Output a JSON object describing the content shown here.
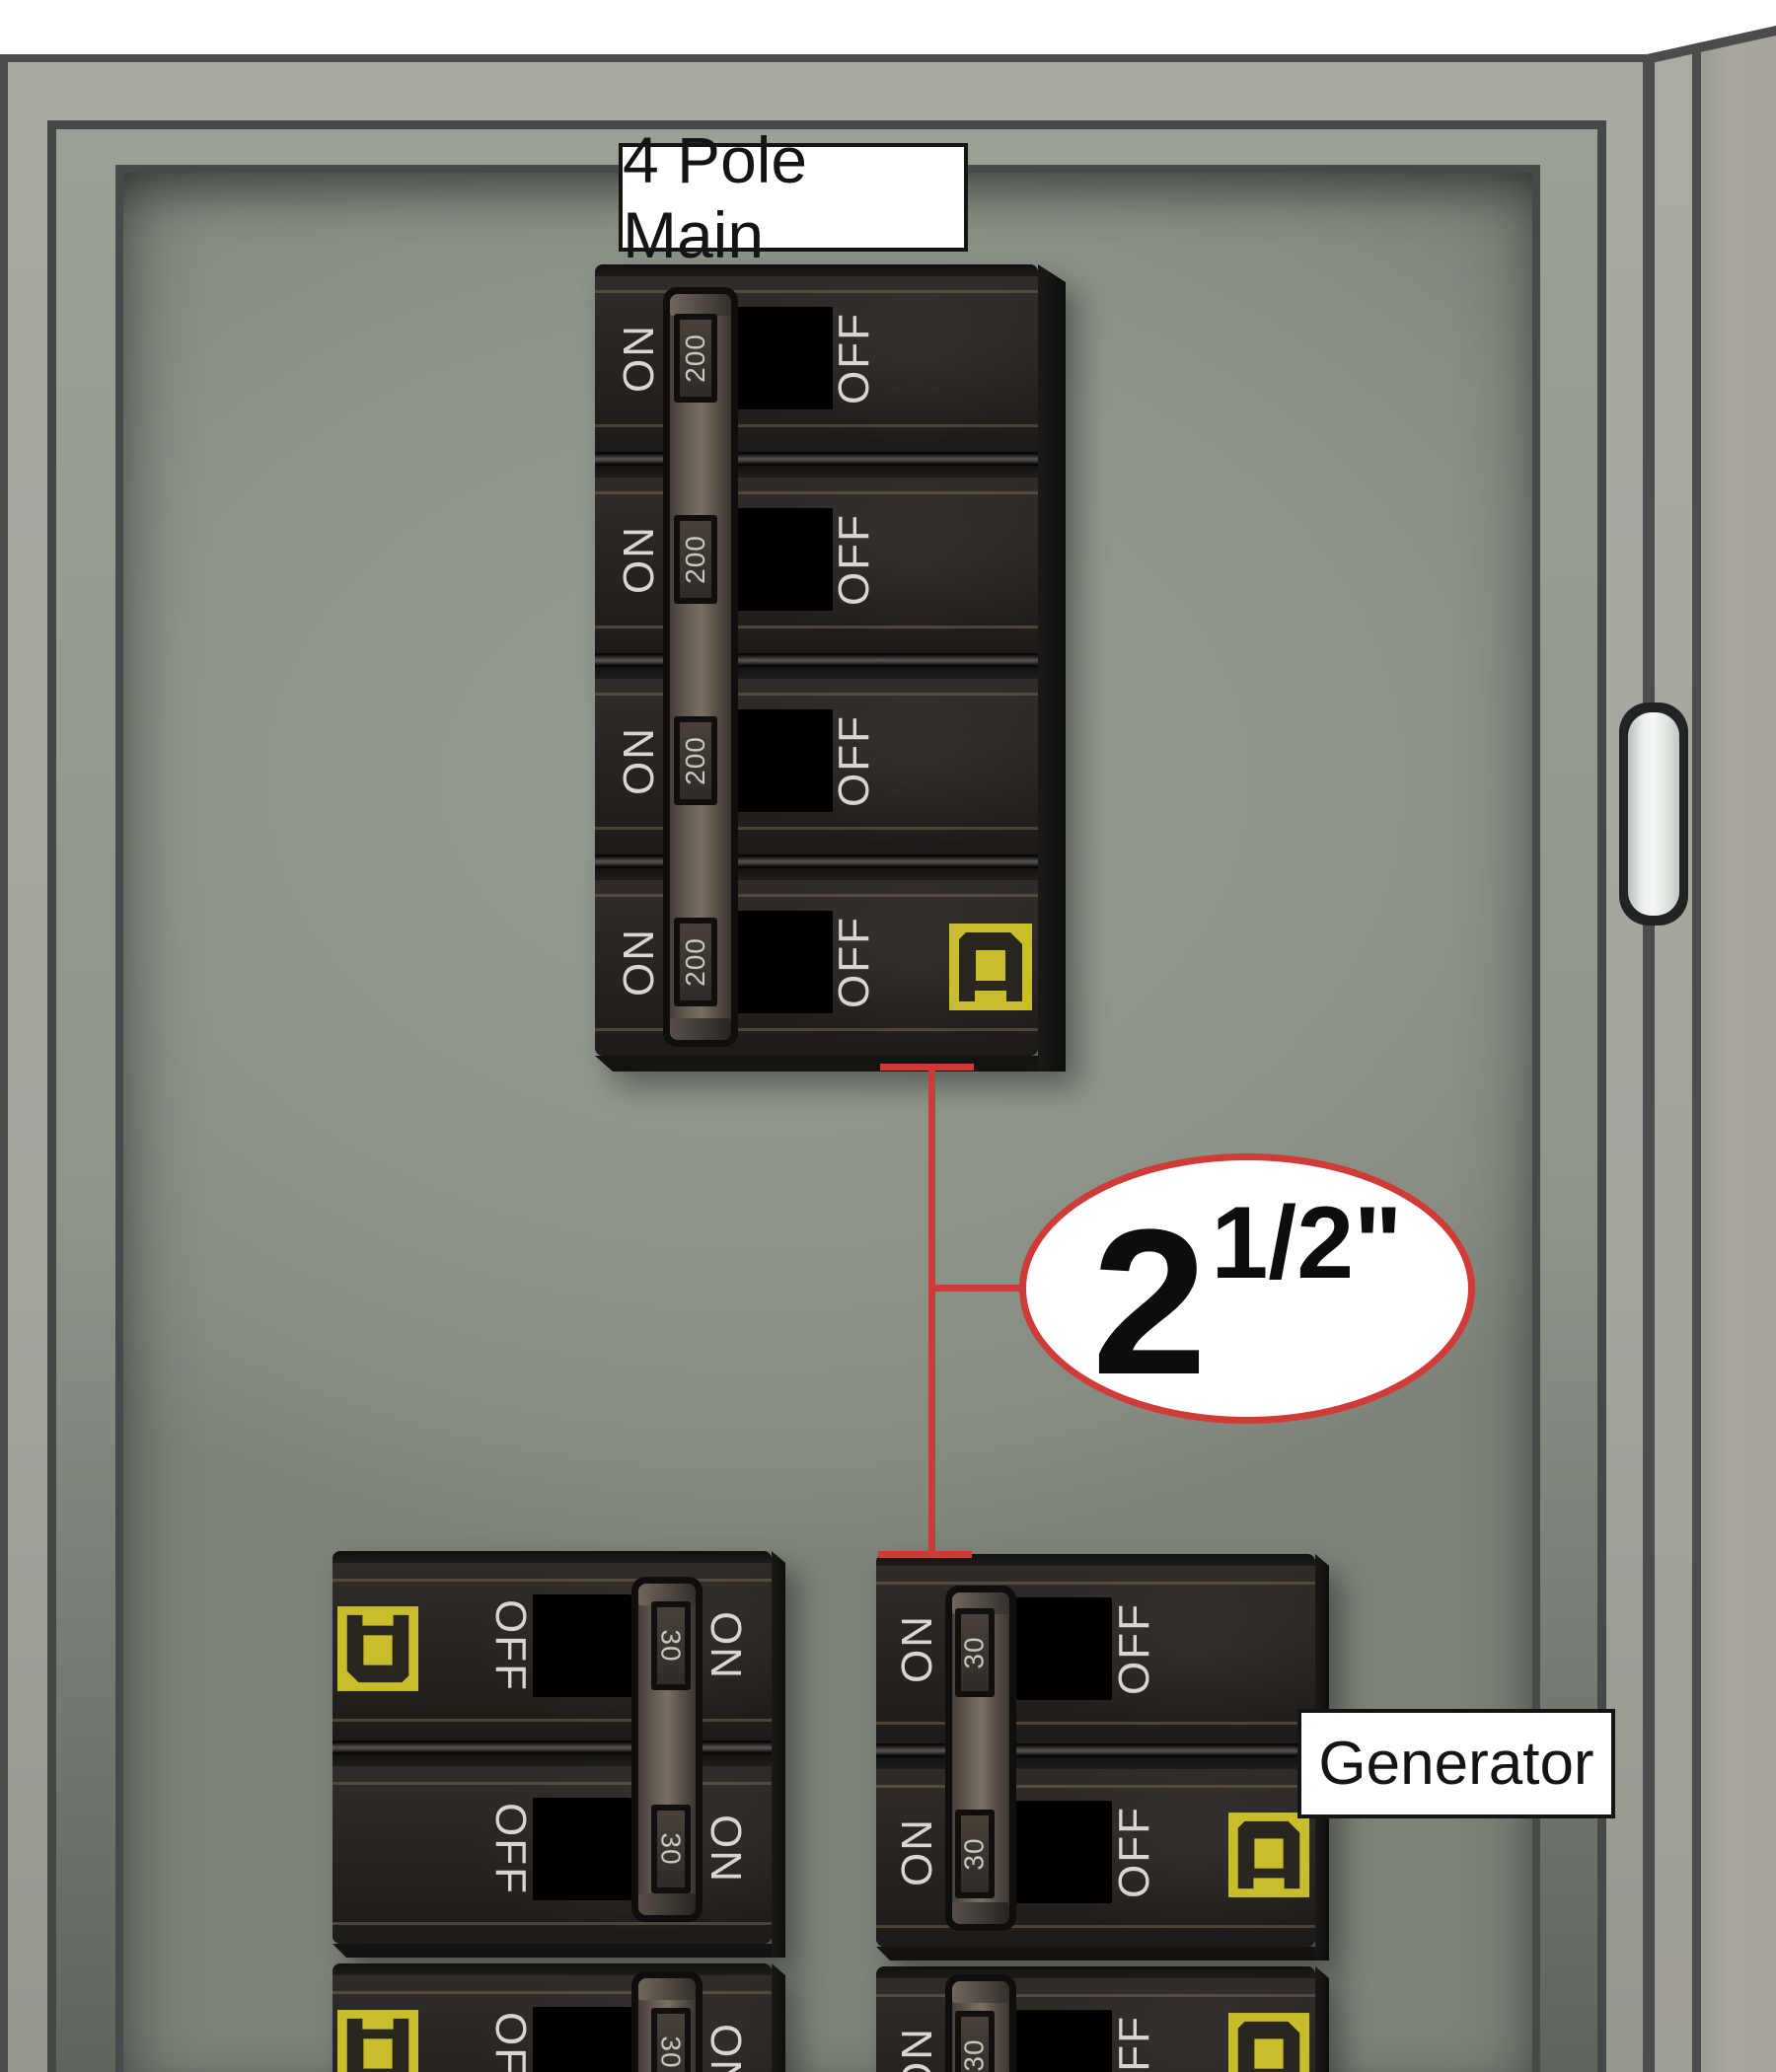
{
  "scene_title": "Electrical panel with 4 pole main breaker and generator breaker interlock",
  "colors": {
    "callout_red": "#cf3936",
    "square_d_yellow": "#c8bd2b",
    "breaker_body": "#262320",
    "door_gray": "#8e948a",
    "label_ink": "#141414",
    "label_bg": "#ffffff",
    "breaker_text": "#d8d6d2"
  },
  "callouts": {
    "main_label": "4 Pole Main",
    "generator_label": "Generator",
    "conduit": {
      "whole": "2",
      "sup": "1/2\""
    }
  },
  "main_breaker": {
    "state": "ON",
    "poles": [
      {
        "on_label": "ON",
        "rating": "200",
        "off_label": "OFF"
      },
      {
        "on_label": "ON",
        "rating": "200",
        "off_label": "OFF"
      },
      {
        "on_label": "ON",
        "rating": "200",
        "off_label": "OFF"
      },
      {
        "on_label": "ON",
        "rating": "200",
        "off_label": "OFF"
      }
    ]
  },
  "left_breaker": {
    "state": "ON",
    "poles": [
      {
        "off_label": "OFF",
        "rating": "30",
        "on_label": "ON"
      },
      {
        "off_label": "OFF",
        "rating": "30",
        "on_label": "ON"
      }
    ],
    "partial_pole": {
      "off_label": "OFF",
      "rating": "30",
      "on_label": "ON"
    }
  },
  "right_breaker": {
    "state": "ON",
    "poles": [
      {
        "on_label": "ON",
        "rating": "30",
        "off_label": "OFF"
      },
      {
        "on_label": "ON",
        "rating": "30",
        "off_label": "OFF"
      }
    ],
    "partial_pole": {
      "on_label": "ON",
      "rating": "30",
      "off_label": "OFF"
    }
  }
}
